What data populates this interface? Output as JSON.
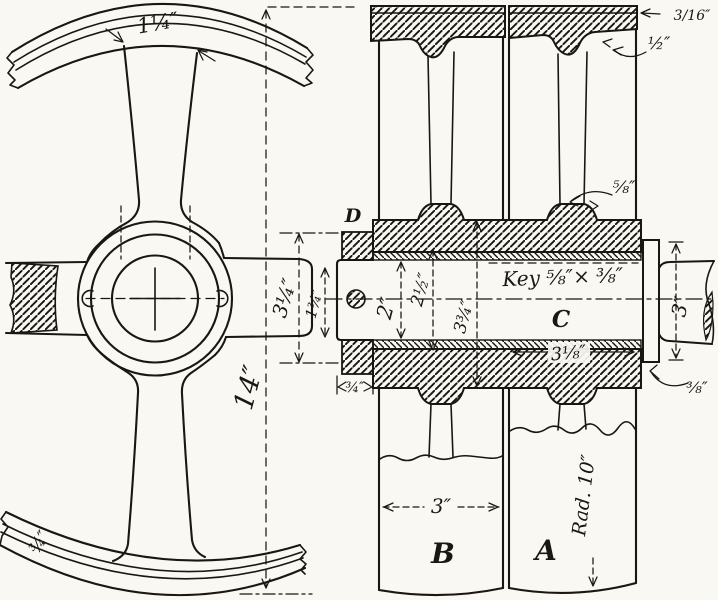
{
  "drawing": {
    "paper_color": "#f9f8f2",
    "ink_color": "#1a1713",
    "front_view": {
      "spoke_width": "1¼″",
      "wheel_span": "14″",
      "hub_height": "3¼″",
      "shaft_stub_dia": "1¾″",
      "rim_thickness": "¾″"
    },
    "section_view": {
      "part_labels": {
        "pulley_a": "A",
        "pulley_b": "B",
        "shaft": "C",
        "hub": "D"
      },
      "shaft_dia": "2″",
      "bore_dia": "2½″",
      "hub_dia": "3¾″",
      "key_note": "Key ⅝″× ⅜″",
      "hub_length": "3⅛″",
      "collar_width": "¾″",
      "set_off": "⅜″",
      "shaft_end_dia": "3″",
      "face_width": "3″",
      "rim_radius": "Rad. 10″",
      "rim_plate": "3/16″",
      "groove_depth": "½″",
      "arm_boss": "⅝″"
    }
  }
}
